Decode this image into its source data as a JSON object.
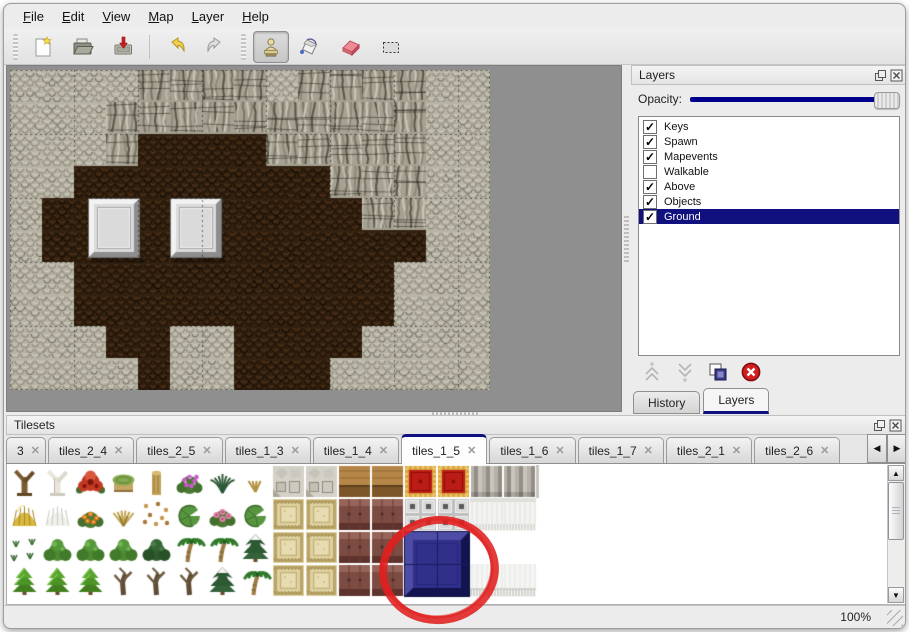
{
  "menu": {
    "items": [
      "File",
      "Edit",
      "View",
      "Map",
      "Layer",
      "Help"
    ]
  },
  "toolbar": {
    "buttons": [
      {
        "name": "new",
        "icon": "new-file-icon"
      },
      {
        "name": "open",
        "icon": "open-folder-icon"
      },
      {
        "name": "save",
        "icon": "save-icon"
      },
      {
        "name": "undo",
        "icon": "undo-arrow-icon"
      },
      {
        "name": "redo",
        "icon": "redo-arrow-icon"
      },
      {
        "name": "stamp-tool",
        "icon": "stamp-icon",
        "active": true
      },
      {
        "name": "fill-tool",
        "icon": "paint-bucket-icon"
      },
      {
        "name": "eraser-tool",
        "icon": "eraser-icon"
      },
      {
        "name": "select-tool",
        "icon": "selection-rect-icon"
      }
    ]
  },
  "layers_panel": {
    "title": "Layers",
    "opacity_label": "Opacity:",
    "opacity_percent": 100,
    "layers": [
      {
        "name": "Keys",
        "checked": true,
        "selected": false
      },
      {
        "name": "Spawn",
        "checked": true,
        "selected": false
      },
      {
        "name": "Mapevents",
        "checked": true,
        "selected": false
      },
      {
        "name": "Walkable",
        "checked": false,
        "selected": false
      },
      {
        "name": "Above",
        "checked": true,
        "selected": false
      },
      {
        "name": "Objects",
        "checked": true,
        "selected": false
      },
      {
        "name": "Ground",
        "checked": true,
        "selected": true
      }
    ],
    "action_buttons": [
      "raise-layer",
      "lower-layer",
      "merge-layer",
      "delete-layer"
    ],
    "tabs": [
      {
        "label": "History",
        "active": false
      },
      {
        "label": "Layers",
        "active": true
      }
    ]
  },
  "map": {
    "tile_size": 32,
    "grid": [
      "ggggccccgccccgg",
      "gggccccccccccgg",
      "gggcbbbbcccccgg",
      "ggbbbbbbbbcccgg",
      "gbbbbbbbbbbccgg",
      "gbbbbbbbbbbbbgg",
      "ggbbbbbbbbbbggg",
      "ggbbbbbbbbbbggg",
      "gggbbggbbbbgggg",
      "ggggbggbbbggggg"
    ],
    "palette": {
      "ground": "#b7b3a5",
      "cliff": "#a6a192",
      "floor": "#33210f"
    },
    "pedestals": [
      {
        "x": 78,
        "y": 128,
        "w": 52,
        "h": 66
      },
      {
        "x": 160,
        "y": 128,
        "w": 52,
        "h": 66
      }
    ]
  },
  "tilesets_panel": {
    "title": "Tilesets",
    "tabs": [
      {
        "label": "3",
        "active": false,
        "truncated": true
      },
      {
        "label": "tiles_2_4",
        "active": false
      },
      {
        "label": "tiles_2_5",
        "active": false
      },
      {
        "label": "tiles_1_3",
        "active": false
      },
      {
        "label": "tiles_1_4",
        "active": false
      },
      {
        "label": "tiles_1_5",
        "active": true
      },
      {
        "label": "tiles_1_6",
        "active": false
      },
      {
        "label": "tiles_1_7",
        "active": false
      },
      {
        "label": "tiles_2_1",
        "active": false
      },
      {
        "label": "tiles_2_6",
        "active": false
      }
    ],
    "grid": [
      "abcdefghQQNNRRCC",
      "ysoulLpLKKBBGGWW",
      "vmmmMPPSKKBBUU..",
      "VVVDDDSPKKBBUUFF"
    ],
    "legend": {
      "a": "tree-trunk",
      "b": "white-branch-tree",
      "c": "red-flower",
      "d": "mossy-stump",
      "e": "tan-trunk",
      "f": "purple-flower-bush",
      "g": "fern",
      "h": "dry-weed",
      "y": "hay-mound",
      "s": "snow-mound",
      "o": "orange-flowers",
      "u": "dry-grass",
      "l": "fallen-leaves",
      "L": "lily-pad",
      "p": "pink-flower-bush",
      "v": "small-sprigs",
      "m": "green-bush",
      "M": "dark-bush",
      "P": "palm-tree",
      "S": "snowy-tree",
      "V": "conical-bush",
      "D": "dead-tree",
      "Q": "stone-floor",
      "K": "tan-carpet",
      "N": "wood-table",
      "B": "maroon-upholstery",
      "R": "red-carpet",
      "G": "gray-blocks",
      "C": "gray-curtain",
      "W": "white-curtain",
      "F": "white-fringe",
      "U": "blue-tile-selected",
      ".": "empty"
    },
    "annotation": {
      "shape": "red-circle",
      "color": "#e02020",
      "center_x": 435,
      "center_y": 566,
      "rx": 56,
      "ry": 50
    }
  },
  "statusbar": {
    "zoom_label": "100%"
  },
  "colors": {
    "selection": "#10107e",
    "slider_track": "#00008b",
    "canvas_background": "#8f8f8f"
  }
}
